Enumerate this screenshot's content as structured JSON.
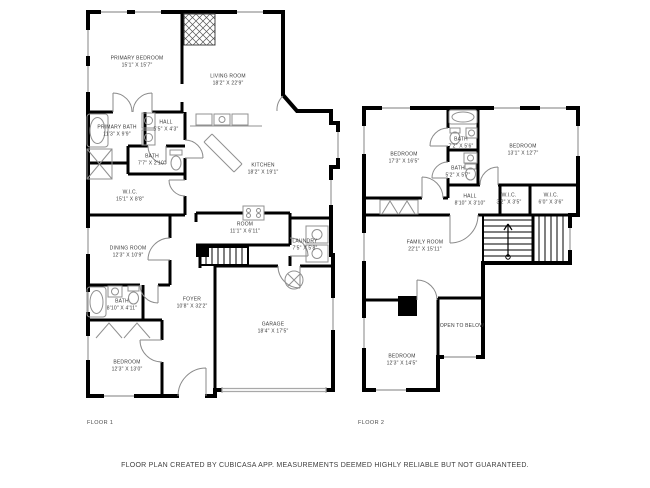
{
  "colors": {
    "walls": "#000000",
    "windows": "#a8a8a8",
    "fixtures": "#909090",
    "text": "#3a3a3a",
    "background": "#ffffff"
  },
  "floor1": {
    "label": "FLOOR 1",
    "rooms": {
      "primary_bedroom": {
        "name": "PRIMARY BEDROOM",
        "dims": "15'1\" X 15'7\""
      },
      "living_room": {
        "name": "LIVING ROOM",
        "dims": "18'2\" X 22'9\""
      },
      "primary_bath": {
        "name": "PRIMARY BATH",
        "dims": "11'3\" X 9'9\""
      },
      "hall": {
        "name": "HALL",
        "dims": "5'5\" X 4'3\""
      },
      "bath_small": {
        "name": "BATH",
        "dims": "7'7\" X 2'10\""
      },
      "wic": {
        "name": "W.I.C.",
        "dims": "15'1\" X 8'8\""
      },
      "kitchen": {
        "name": "KITCHEN",
        "dims": "18'2\" X 19'1\""
      },
      "room": {
        "name": "ROOM",
        "dims": "11'1\" X 6'11\""
      },
      "laundry": {
        "name": "LAUNDRY",
        "dims": "7'5\" X 5'8\""
      },
      "dining_room": {
        "name": "DINING ROOM",
        "dims": "12'3\" X 10'9\""
      },
      "bath": {
        "name": "BATH",
        "dims": "8'10\" X 4'11\""
      },
      "foyer": {
        "name": "FOYER",
        "dims": "10'8\" X 32'2\""
      },
      "bedroom": {
        "name": "BEDROOM",
        "dims": "12'3\" X 13'0\""
      },
      "garage": {
        "name": "GARAGE",
        "dims": "18'4\" X 17'5\""
      }
    }
  },
  "floor2": {
    "label": "FLOOR 2",
    "rooms": {
      "bedroom_left": {
        "name": "BEDROOM",
        "dims": "17'3\" X 16'5\""
      },
      "bath_top": {
        "name": "BATH",
        "dims": "7'2\" X 5'6\""
      },
      "bath_mid": {
        "name": "BATH",
        "dims": "5'2\" X 5'7\""
      },
      "bedroom_right": {
        "name": "BEDROOM",
        "dims": "13'1\" X 12'7\""
      },
      "hall": {
        "name": "HALL",
        "dims": "8'10\" X 3'10\""
      },
      "wic_small": {
        "name": "W.I.C.",
        "dims": "3'2\" X 3'5\""
      },
      "wic_large": {
        "name": "W.I.C.",
        "dims": "6'0\" X 3'6\""
      },
      "family_room": {
        "name": "FAMILY ROOM",
        "dims": "22'1\" X 15'11\""
      },
      "open_to_below": {
        "name": "OPEN TO BELOW"
      },
      "bedroom_bottom": {
        "name": "BEDROOM",
        "dims": "12'3\" X 14'5\""
      }
    }
  },
  "footer": {
    "disclaimer": "FLOOR PLAN CREATED BY CUBICASA APP. MEASUREMENTS DEEMED HIGHLY RELIABLE BUT NOT GUARANTEED."
  }
}
